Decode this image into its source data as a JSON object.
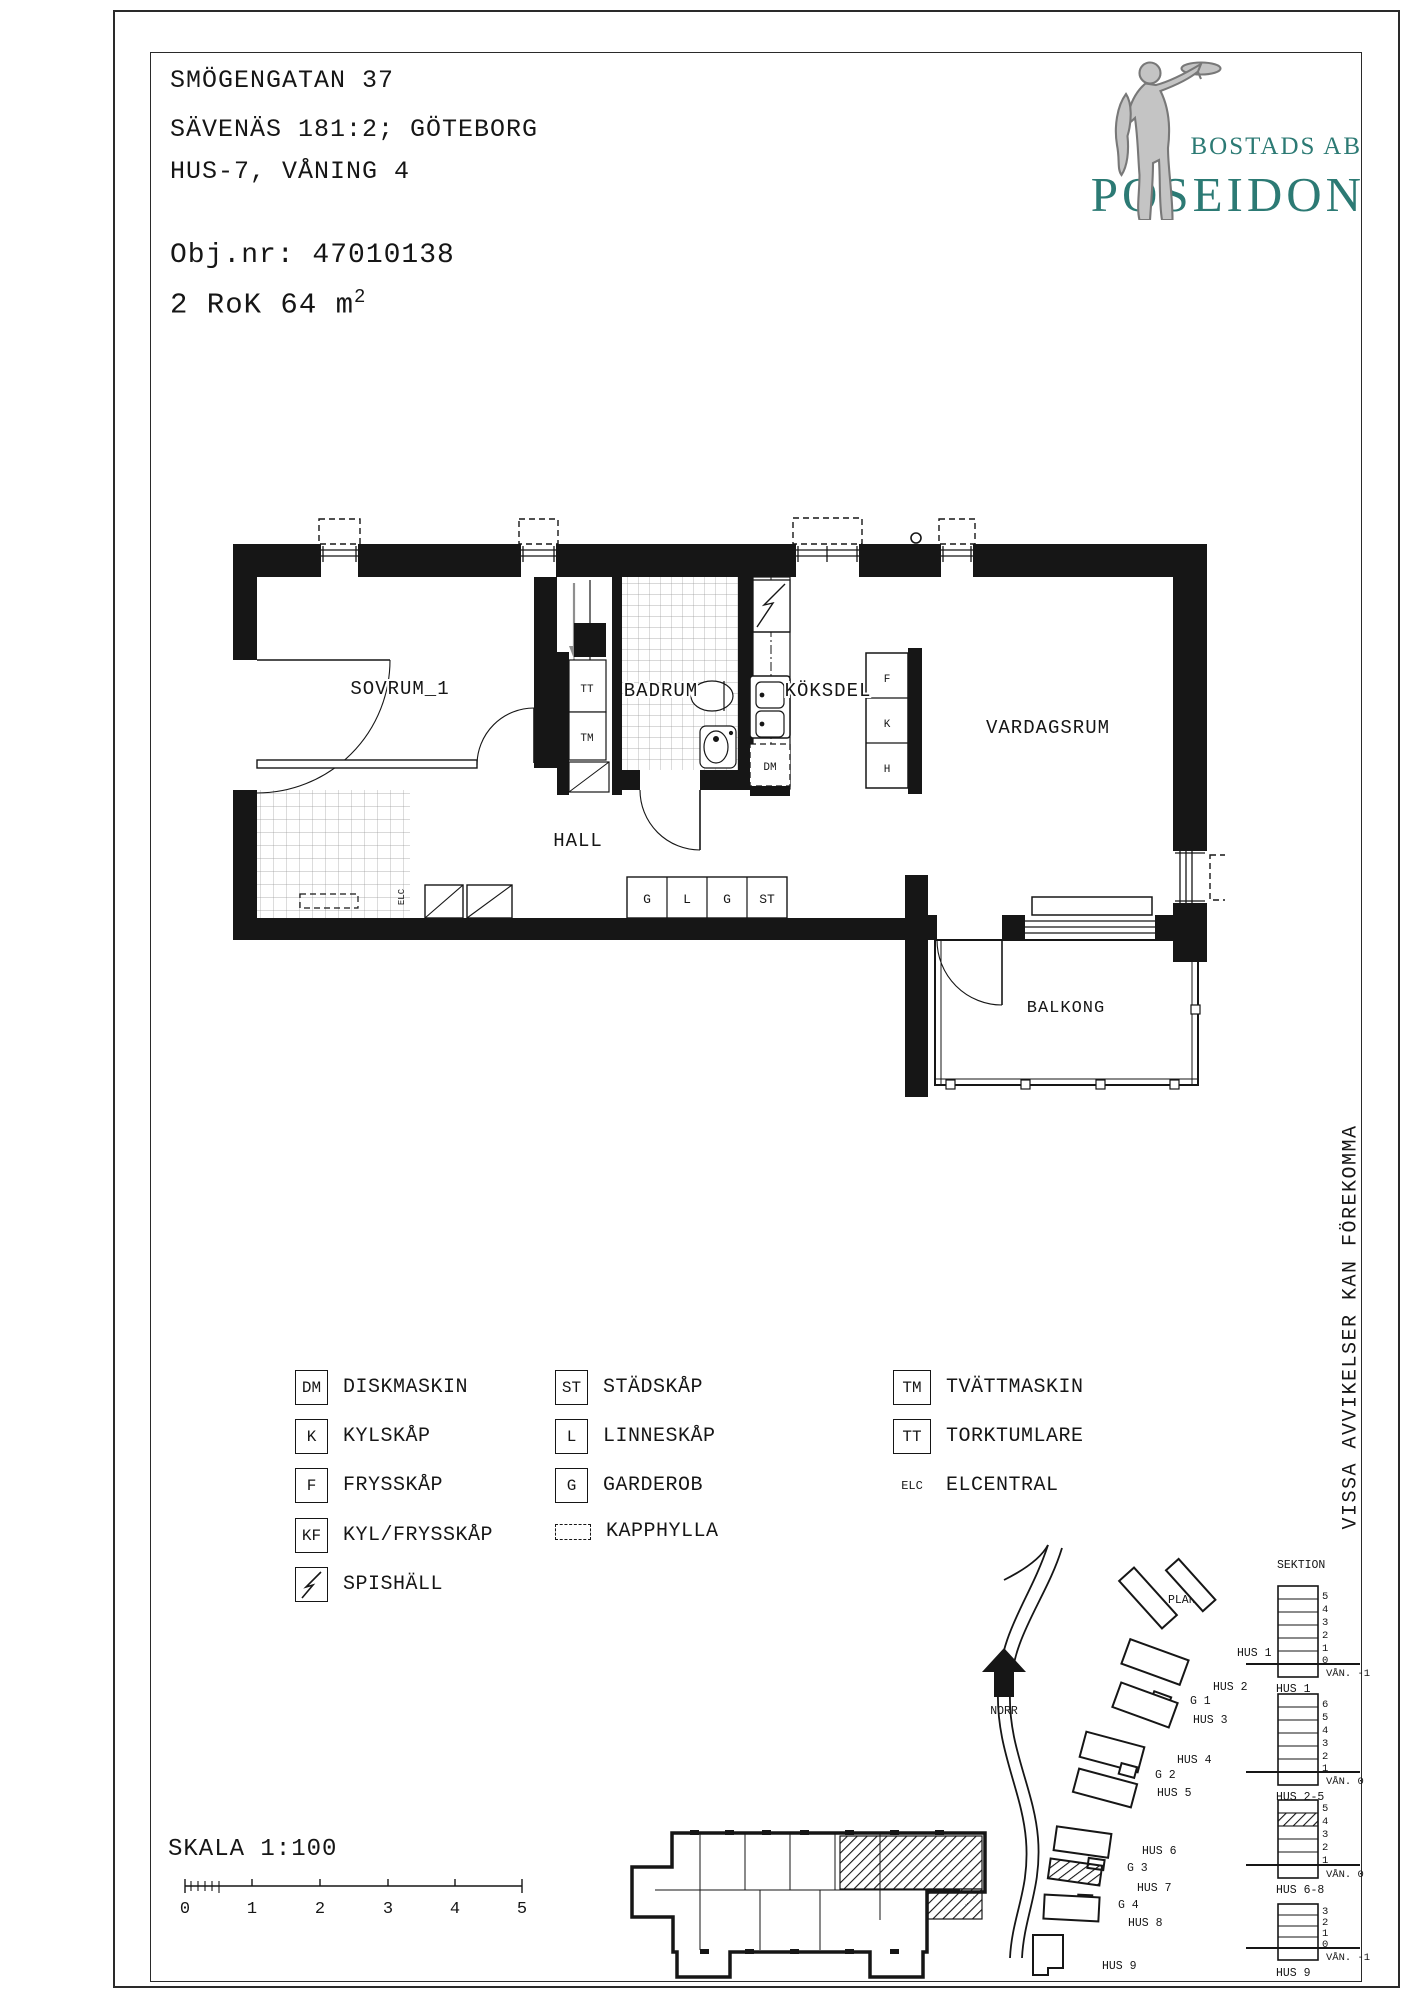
{
  "header": {
    "line1": "SMÖGENGATAN 37",
    "line2": "SÄVENÄS 181:2; GÖTEBORG",
    "line3": "HUS-7, VÅNING 4",
    "obj": "Obj.nr: 47010138",
    "size_prefix": "2 RoK 64 m",
    "size_sup": "2"
  },
  "brand": {
    "top": "BOSTADS AB",
    "name": "POSEIDON",
    "teal": "#2c7a74",
    "statue_grey": "#c4c4c4"
  },
  "plan": {
    "rooms": {
      "sovrum": "SOVRUM_1",
      "badrum": "BADRUM",
      "koksdel": "KÖKSDEL",
      "vardagsrum": "VARDAGSRUM",
      "hall": "HALL",
      "balkong": "BALKONG"
    },
    "fixtures": {
      "tt": "TT",
      "tm": "TM",
      "dm": "DM",
      "f": "F",
      "k": "K",
      "h": "H",
      "g1": "G",
      "l": "L",
      "g2": "G",
      "st": "ST",
      "elc": "ELC"
    }
  },
  "legend": {
    "col1": [
      {
        "key": "DM",
        "label": "DISKMASKIN"
      },
      {
        "key": "K",
        "label": "KYLSKÅP"
      },
      {
        "key": "F",
        "label": "FRYSSKÅP"
      },
      {
        "key": "KF",
        "label": "KYL/FRYSSKÅP"
      },
      {
        "key": "",
        "label": "SPISHÄLL"
      }
    ],
    "col2": [
      {
        "key": "ST",
        "label": "STÄDSKÅP"
      },
      {
        "key": "L",
        "label": "LINNESKÅP"
      },
      {
        "key": "G",
        "label": "GARDEROB"
      },
      {
        "key": "",
        "label": "KAPPHYLLA"
      }
    ],
    "col3": [
      {
        "key": "TM",
        "label": "TVÄTTMASKIN"
      },
      {
        "key": "TT",
        "label": "TORKTUMLARE"
      },
      {
        "key": "ELC",
        "label": "ELCENTRAL"
      }
    ]
  },
  "note_vertical": "VISSA AVVIKELSER KAN FÖREKOMMA",
  "scale": {
    "label": "SKALA 1:100",
    "ticks": [
      "0",
      "1",
      "2",
      "3",
      "4",
      "5"
    ]
  },
  "site": {
    "plan_label": "PLAN",
    "north_label": "NORR",
    "sektion_label": "SEKTION",
    "hus": [
      "HUS 1",
      "HUS 2",
      "G 1",
      "HUS 3",
      "HUS 4",
      "G 2",
      "HUS 5",
      "HUS 6",
      "G 3",
      "HUS 7",
      "G 4",
      "HUS 8",
      "HUS 9"
    ],
    "sections": [
      {
        "name": "HUS 1",
        "van": "VÅN. -1",
        "floors": [
          "5",
          "4",
          "3",
          "2",
          "1",
          "0"
        ]
      },
      {
        "name": "HUS 2-5",
        "van": "VÅN. 0",
        "floors": [
          "6",
          "5",
          "4",
          "3",
          "2",
          "1"
        ]
      },
      {
        "name": "HUS 6-8",
        "van": "VÅN. 0",
        "floors": [
          "5",
          "4",
          "3",
          "2",
          "1"
        ]
      },
      {
        "name": "HUS 9",
        "van": "VÅN. -1",
        "floors": [
          "3",
          "2",
          "1",
          "0"
        ]
      }
    ]
  }
}
